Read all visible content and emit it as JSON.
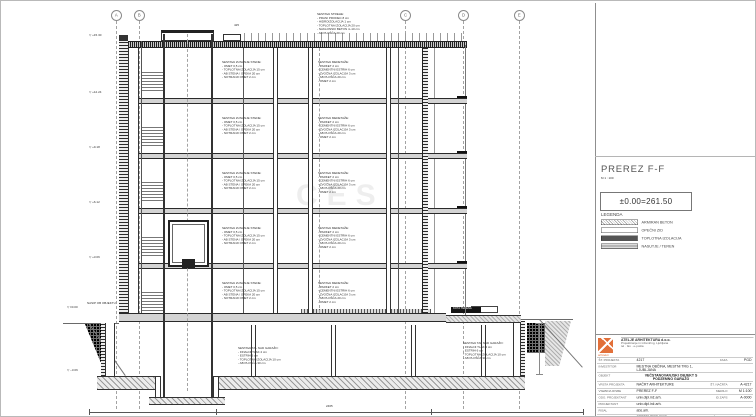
{
  "colors": {
    "accent_orange": "#e2703a",
    "line_dark": "#2a2a2a",
    "grid_gray": "#a3a3a3",
    "slab_gray": "#d4d4d4"
  },
  "watermark": "CES",
  "grid": {
    "axes": [
      "A",
      "B",
      "C",
      "D",
      "E"
    ]
  },
  "panel": {
    "title": "PREREZ F-F",
    "scale": "M 1 : 100",
    "level_datum": "±0.00=261.50",
    "legend_heading": "LEGENDA",
    "legend": [
      {
        "label": "ARMIRAN BETON",
        "swatch": "sw-concrete"
      },
      {
        "label": "OPEČNI ZID",
        "swatch": "sw-brick"
      },
      {
        "label": "TOPLOTNA IZOLACIJA",
        "swatch": "sw-insul"
      },
      {
        "label": "NASUTJE / TEREN",
        "swatch": "sw-fill"
      }
    ],
    "titleblock": {
      "logo_caption": "arhitekti",
      "company_line1": "ATELJE ARHITEKTURA d.o.o.",
      "company_line2": "Projektiranje in inženiring, Ljubljana",
      "company_line3": "tel · fax · e-pošta",
      "rows": [
        {
          "label": "ŠT. PROJEKTA",
          "value": "4217",
          "label2": "FAZA",
          "value2": "PGD"
        },
        {
          "label": "INVESTITOR",
          "value": "MESTNA OBČINA, MESTNI TRG 1, LJUBLJANA",
          "label2": "",
          "value2": ""
        },
        {
          "label": "OBJEKT",
          "value": "VEČSTANOVANJSKI OBJEKT S PODZEMNO GARAŽO",
          "label2": "",
          "value2": "",
          "emph": true
        },
        {
          "label": "VRSTA PROJEKTA",
          "value": "NAČRT ARHITEKTURE",
          "label2": "ŠT. NAČRTA",
          "value2": "A-4217"
        },
        {
          "label": "VSEBINA RISBE",
          "value": "PREREZ F-F",
          "label2": "MERILO",
          "value2": "M 1:100"
        },
        {
          "label": "ODG. PROJEKTANT",
          "value": "univ.dipl.inž.arh.",
          "label2": "ID ZAPS",
          "value2": "A-0000"
        },
        {
          "label": "PROJEKTANT",
          "value": "univ.dipl.inž.arh.",
          "label2": "",
          "value2": ""
        },
        {
          "label": "RISAL",
          "value": "abs.arh.",
          "label2": "",
          "value2": ""
        },
        {
          "label": "DATUM",
          "value": "SEPTEMBER 2008",
          "label2": "ŠT. RISBE",
          "value2": "9"
        }
      ]
    }
  },
  "drawing": {
    "roof_note": "SESTAVA STREHE:\n- PRANI PRODEC 8 cm\n- HIDROIZOLACIJA 1 cm\n- TOPLOTNA IZOLACIJA 20 cm\n- NAKLONSKI BETON 4–10 cm\n- AB PLOŠČA 20 cm",
    "top_dim": "425",
    "wall_note": "SESTAVA ZUNANJE STENE:\n- OMET 0,5 cm\n- TOPLOTNA IZOLACIJA 15 cm\n- AB STENA / OPEKA 20 cm\n- NOTRANJI OMET 2 cm",
    "floor_note": "SESTAVA MEDETAŽE:\n- PARKET 2 cm\n- CEMENTNI ESTRIH 6 cm\n- ZVOČNA IZOLACIJA 3 cm\n- AB PLOŠČA 20 cm\n- OMET 2 cm",
    "garage_note": "SESTAVA TAL NAD GARAŽO:\n- FINALNI TLAK 2 cm\n- ESTRIH 6 cm\n- TOPLOTNA IZOLACIJA 10 cm\n- AB PLOŠČA 30 cm",
    "left_label": "NASIP OB OBJEKTU",
    "terrain_label": "KOTA TERENA",
    "levels": [
      "+15.30",
      "+12.24",
      "+9.18",
      "+6.12",
      "+3.06",
      "±0.00",
      "−3.06"
    ],
    "height_dim": "306",
    "bottom_dim": "2465"
  }
}
